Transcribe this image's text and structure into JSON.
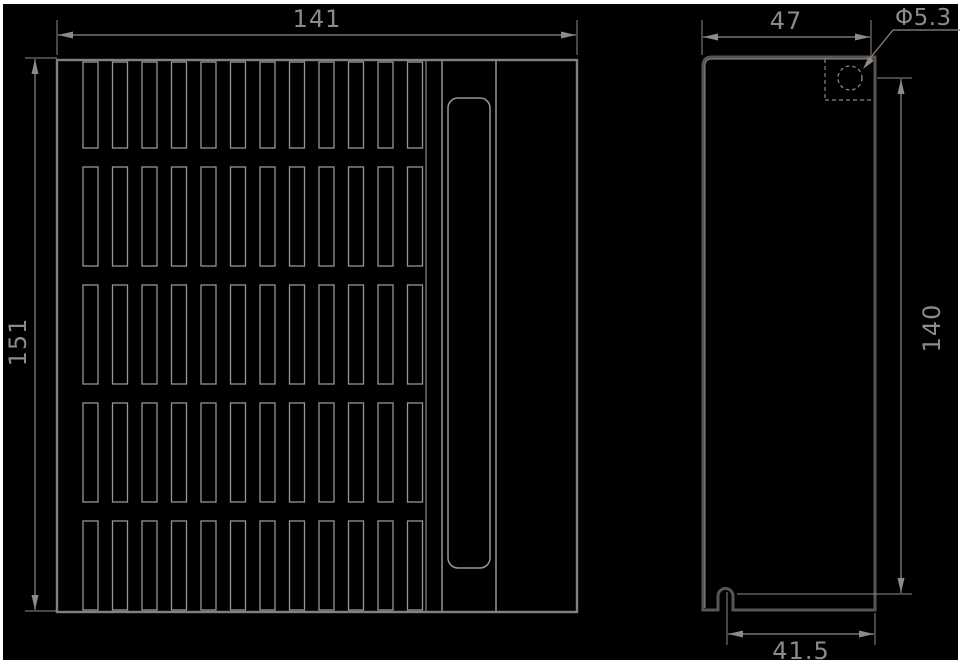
{
  "drawing": {
    "type": "technical-dimension-drawing",
    "views": {
      "front": {
        "description": "front face with ventilation grille and handle slot",
        "grille": {
          "rows": 5,
          "columns": 12
        }
      },
      "side": {
        "description": "side profile with mounting hole and bottom clip"
      }
    },
    "dimensions": {
      "width": {
        "label": "141"
      },
      "height": {
        "label": "151"
      },
      "depth": {
        "label": "47"
      },
      "hole_diameter": {
        "label": "Φ5.3"
      },
      "mount_height": {
        "label": "140"
      },
      "mount_width": {
        "label": "41.5"
      }
    },
    "colors": {
      "background": "#000000",
      "frame": "#ffffff",
      "line_thin": "#9a9591",
      "line_thick": "#575притор",
      "line_thick_fixed": "#575150",
      "text": "#8f8a86"
    }
  }
}
